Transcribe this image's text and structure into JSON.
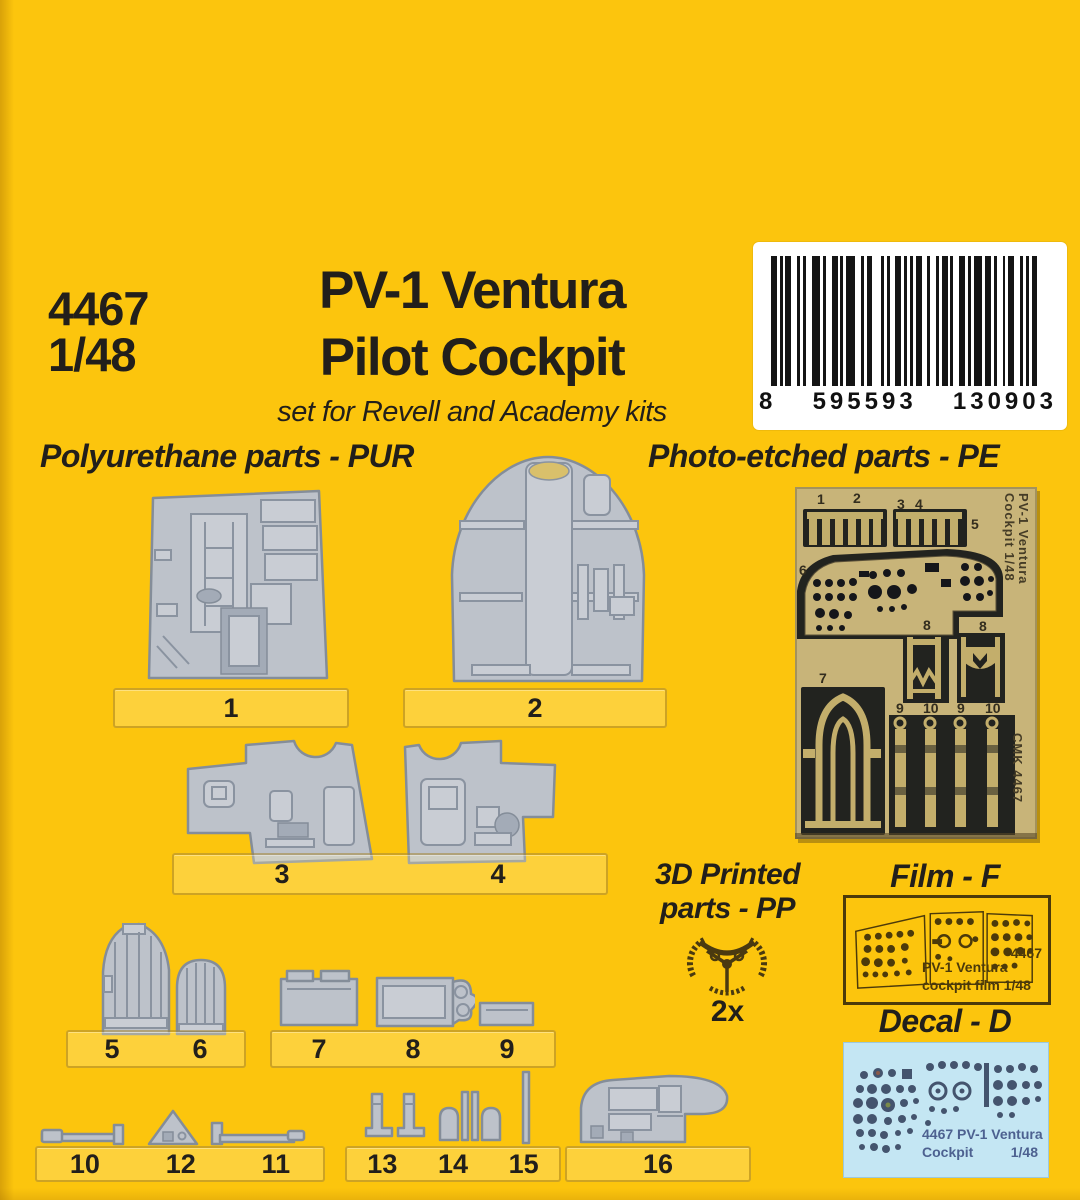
{
  "header": {
    "catalog_number": "4467",
    "scale": "1/48",
    "title_line1": "PV-1 Ventura",
    "title_line2": "Pilot Cockpit",
    "subtitle": "set for Revell and Academy kits",
    "barcode": {
      "digit": "8",
      "group1": "595593",
      "group2": "130903"
    }
  },
  "sections": {
    "pur_heading": "Polyurethane parts - PUR",
    "pe_heading": "Photo-etched parts - PE",
    "pp_heading_line1": "3D Printed",
    "pp_heading_line2": "parts - PP",
    "pp_quantity": "2x",
    "film_heading": "Film - F",
    "decal_heading": "Decal - D"
  },
  "film_label": {
    "number": "4467",
    "line1": "PV-1 Ventura",
    "line2": "cockpit film 1/48"
  },
  "decal_label": {
    "line1": "4467 PV-1 Ventura",
    "line2": "Cockpit",
    "scale": "1/48"
  },
  "pe_fret": {
    "top_numbers": [
      "1",
      "2",
      "3",
      "4",
      "5"
    ],
    "panel_number": "6",
    "seat_number": "7",
    "belt_numbers_upper": [
      "8",
      "8"
    ],
    "belt_numbers_lower": [
      "9",
      "10",
      "9",
      "10"
    ],
    "side_text_line1": "PV-1 Ventura",
    "side_text_line2": "Cockpit  1/48",
    "maker_text": "CMK 4467"
  },
  "part_bars": [
    {
      "numbers": [
        "1"
      ]
    },
    {
      "numbers": [
        "2"
      ]
    },
    {
      "numbers": [
        "3",
        "4"
      ]
    },
    {
      "numbers": [
        "5",
        "6"
      ]
    },
    {
      "numbers": [
        "7",
        "8",
        "9"
      ]
    },
    {
      "numbers": [
        "10",
        "12",
        "11"
      ]
    },
    {
      "numbers": [
        "13",
        "14",
        "15"
      ]
    },
    {
      "numbers": [
        "16"
      ]
    }
  ],
  "colors": {
    "background": "#fcc50d",
    "text": "#221f1b",
    "part-fill": "#bdc2ca",
    "part-stroke": "#848d99",
    "fret-tan": "#c8b479",
    "fret-dark": "#22231f",
    "brass": "#c3ae6b",
    "film-ink": "#4c3a0a",
    "decal-bg": "#c4e6f3",
    "barcode-bg": "#ffffff"
  }
}
